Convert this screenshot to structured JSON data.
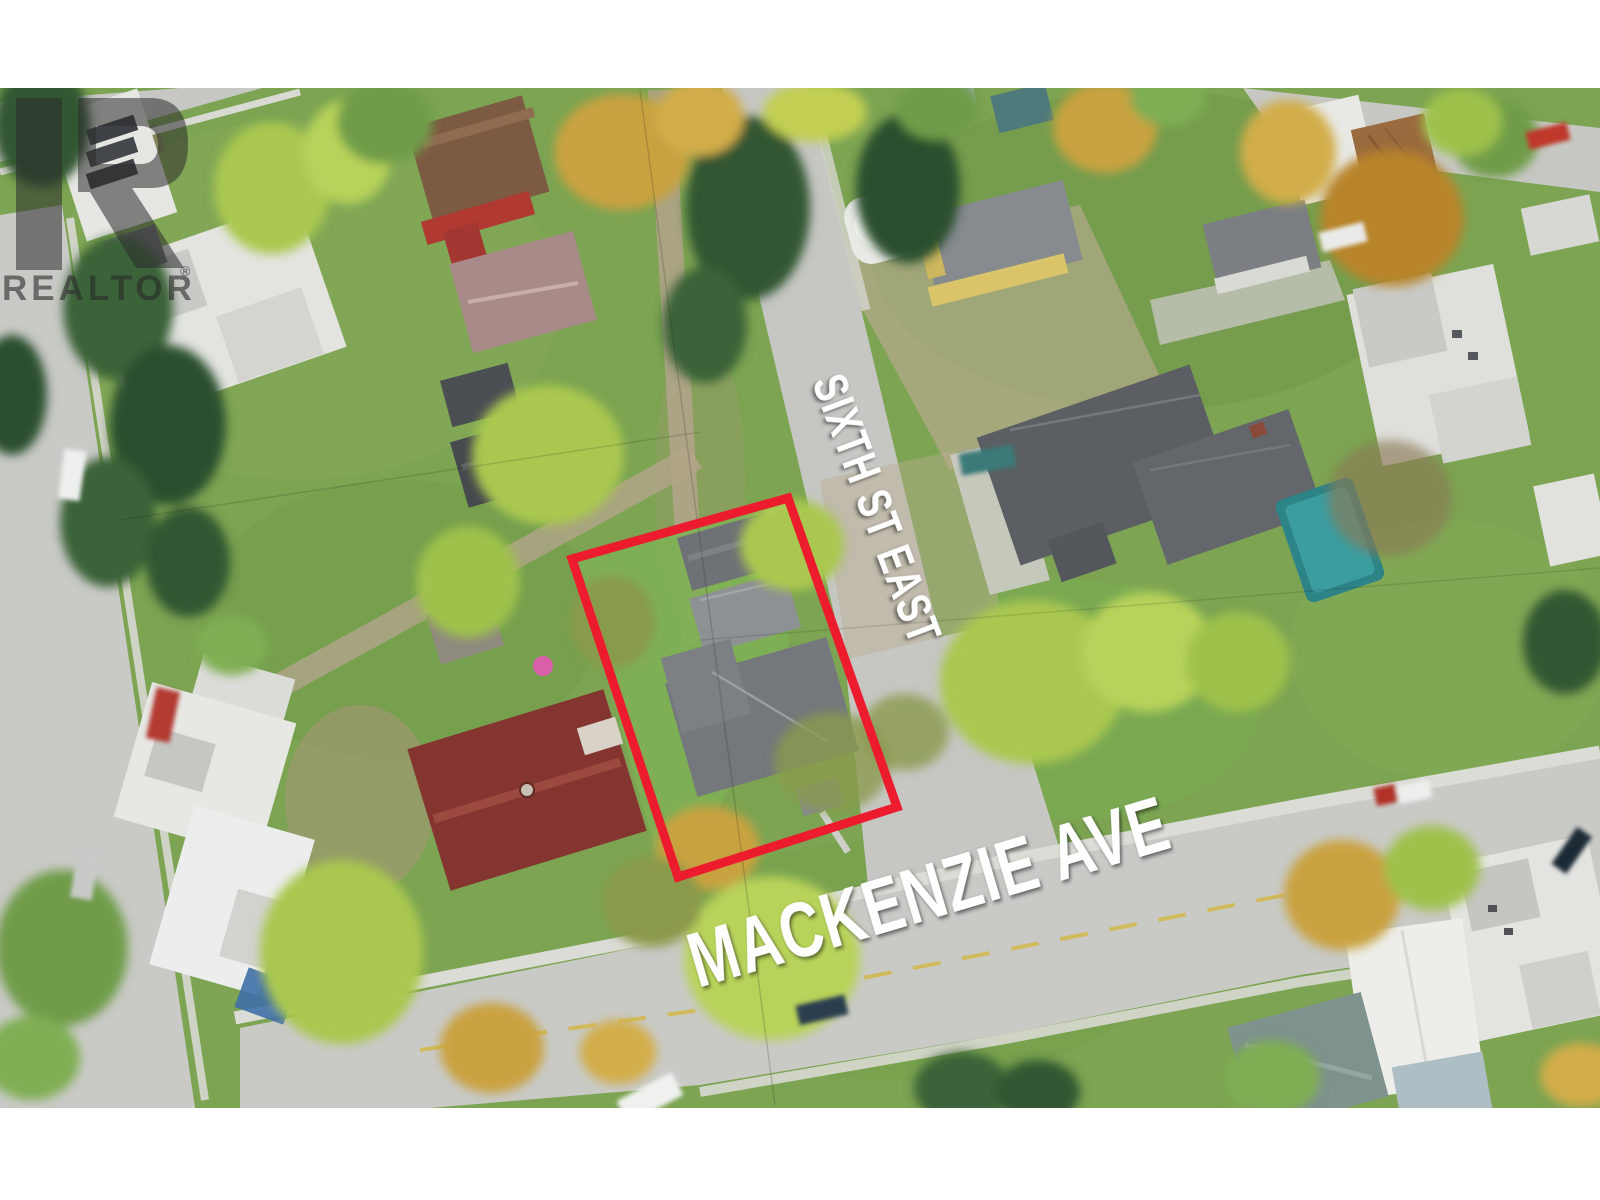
{
  "photo": {
    "description": "Aerial drone photo of a residential neighbourhood with a property lot outlined in red at the corner of Sixth St East and Mackenzie Ave"
  },
  "street_labels": {
    "cross_street": "SIXTH ST EAST",
    "main_street": "MACKENZIE AVE"
  },
  "branding": {
    "watermark_text": "REALTOR",
    "registered_symbol": "®"
  },
  "annotations": {
    "property_outline_color": "#ed1b2e"
  }
}
